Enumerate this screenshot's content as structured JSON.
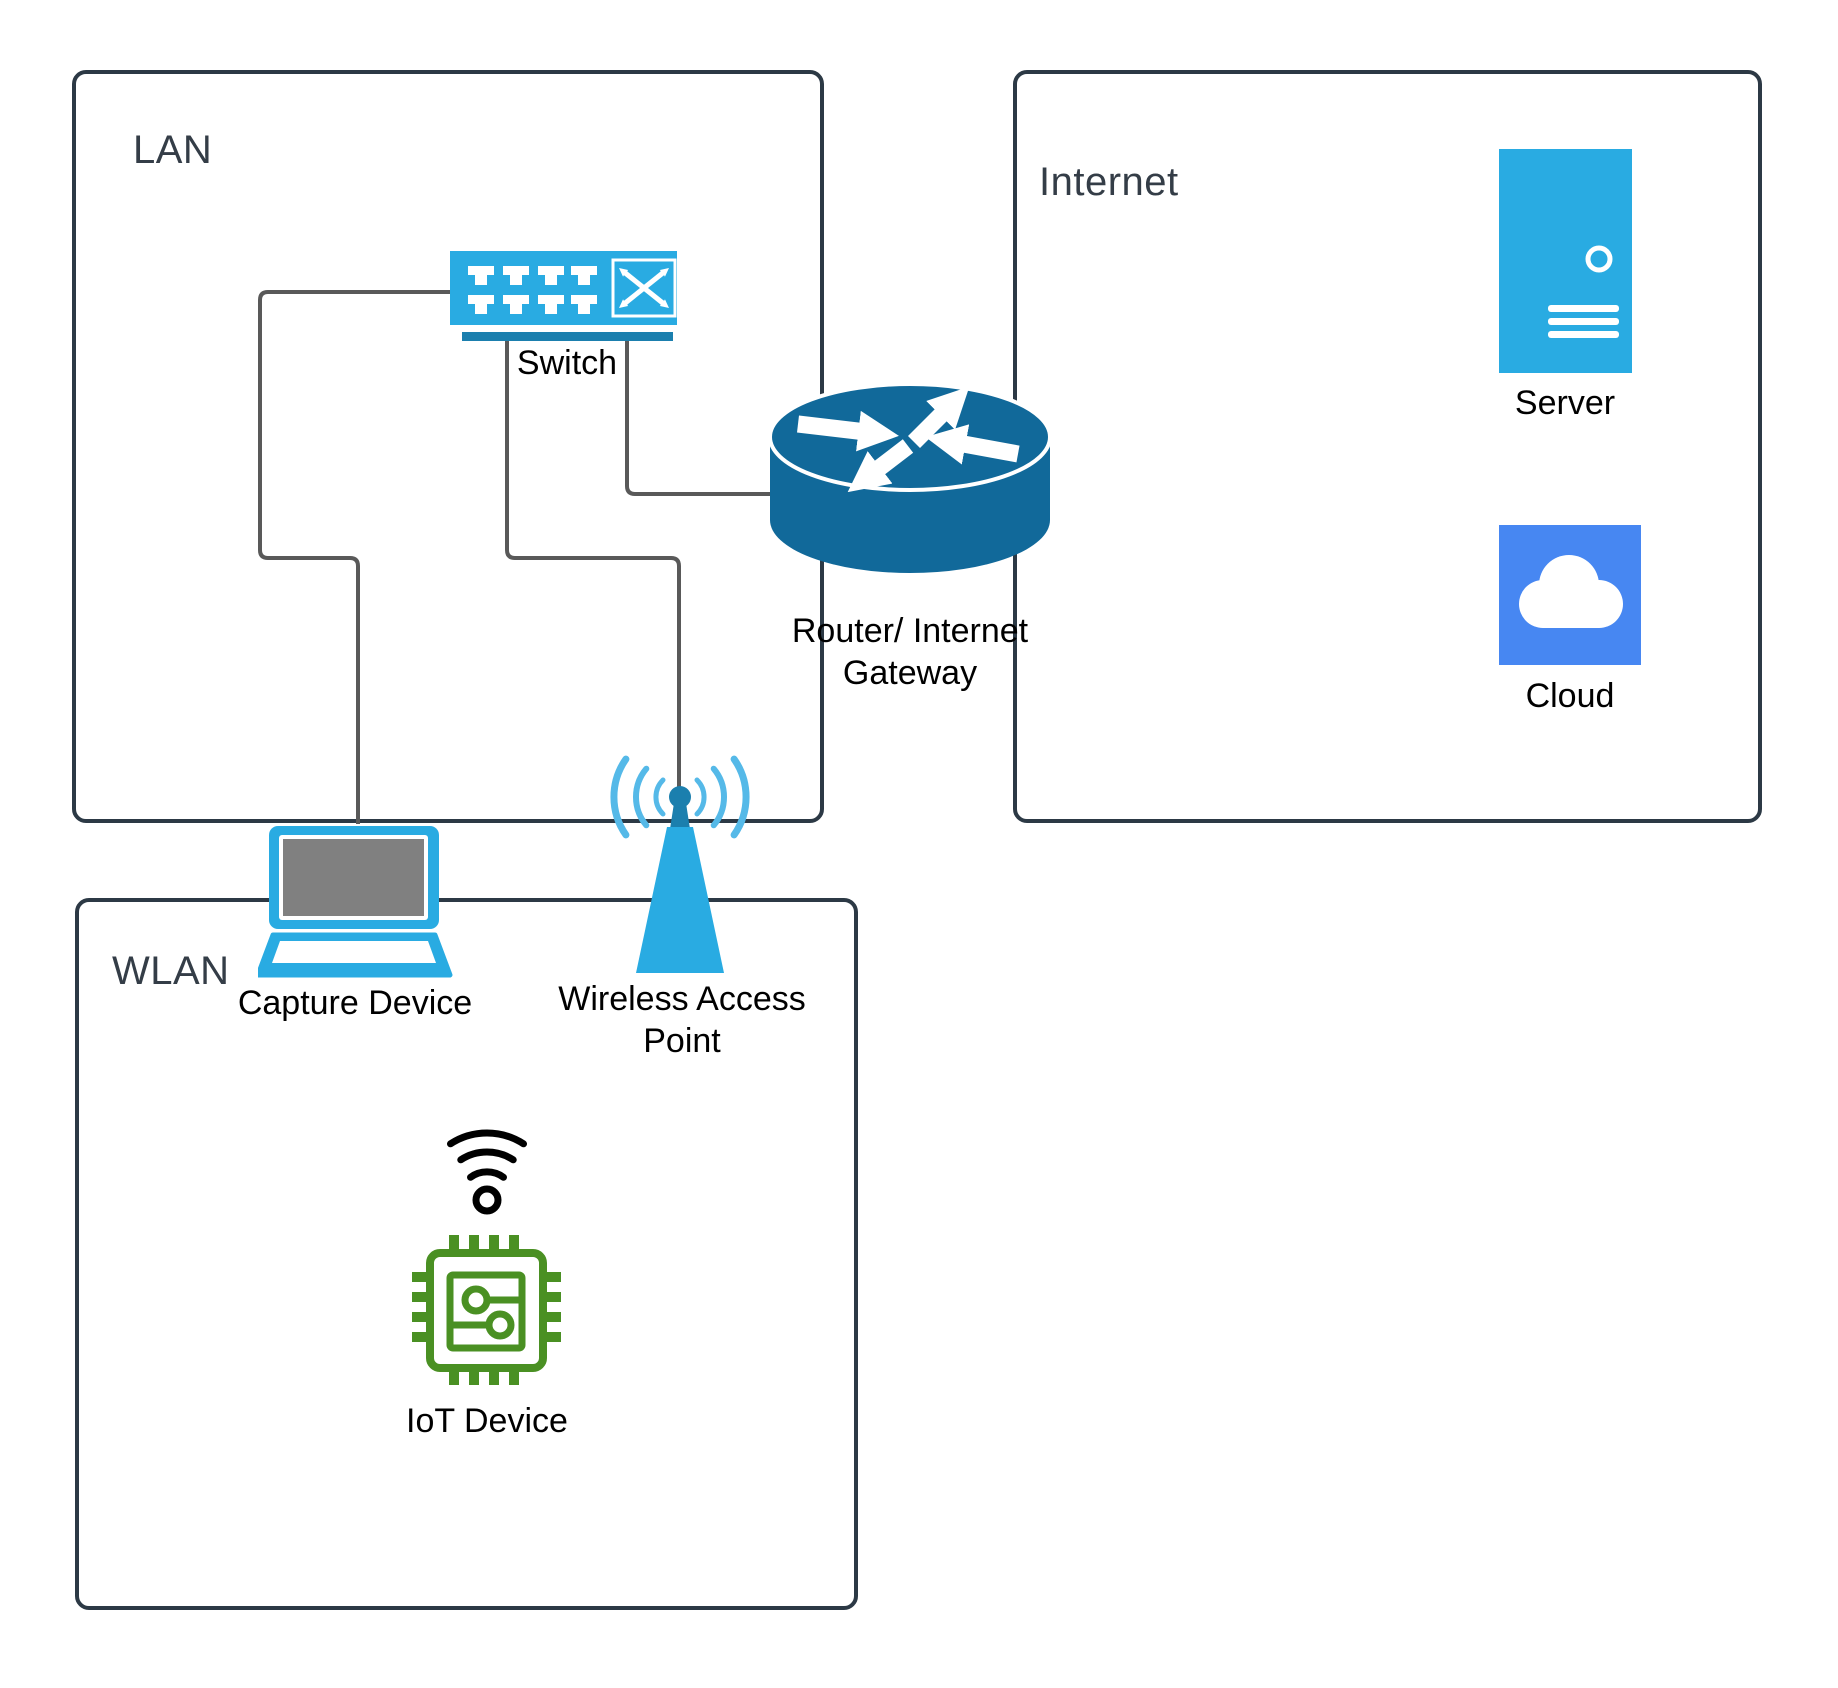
{
  "colors": {
    "box-border": "#2c3945",
    "title-text": "#343d47",
    "label-text": "#000000",
    "wire": "#595959",
    "icon-blue": "#29abe2",
    "icon-blue-dark": "#1b7fae",
    "router-teal": "#11699a",
    "cloud-blue": "#4787f2",
    "screen-gray": "#808080",
    "iot-green": "#4a9023",
    "signal-blue": "#55b9e8",
    "switch-inner-blue": "#4cb5e8"
  },
  "zones": {
    "lan": {
      "title": "LAN"
    },
    "internet": {
      "title": "Internet"
    },
    "wlan": {
      "title": "WLAN"
    }
  },
  "nodes": {
    "switch": {
      "label": "Switch"
    },
    "router": {
      "label": "Router/ Internet Gateway"
    },
    "capture_device": {
      "label": "Capture Device"
    },
    "wireless_access_point": {
      "label": "Wireless Access Point"
    },
    "server": {
      "label": "Server"
    },
    "cloud": {
      "label": "Cloud"
    },
    "iot_device": {
      "label": "IoT Device"
    }
  }
}
